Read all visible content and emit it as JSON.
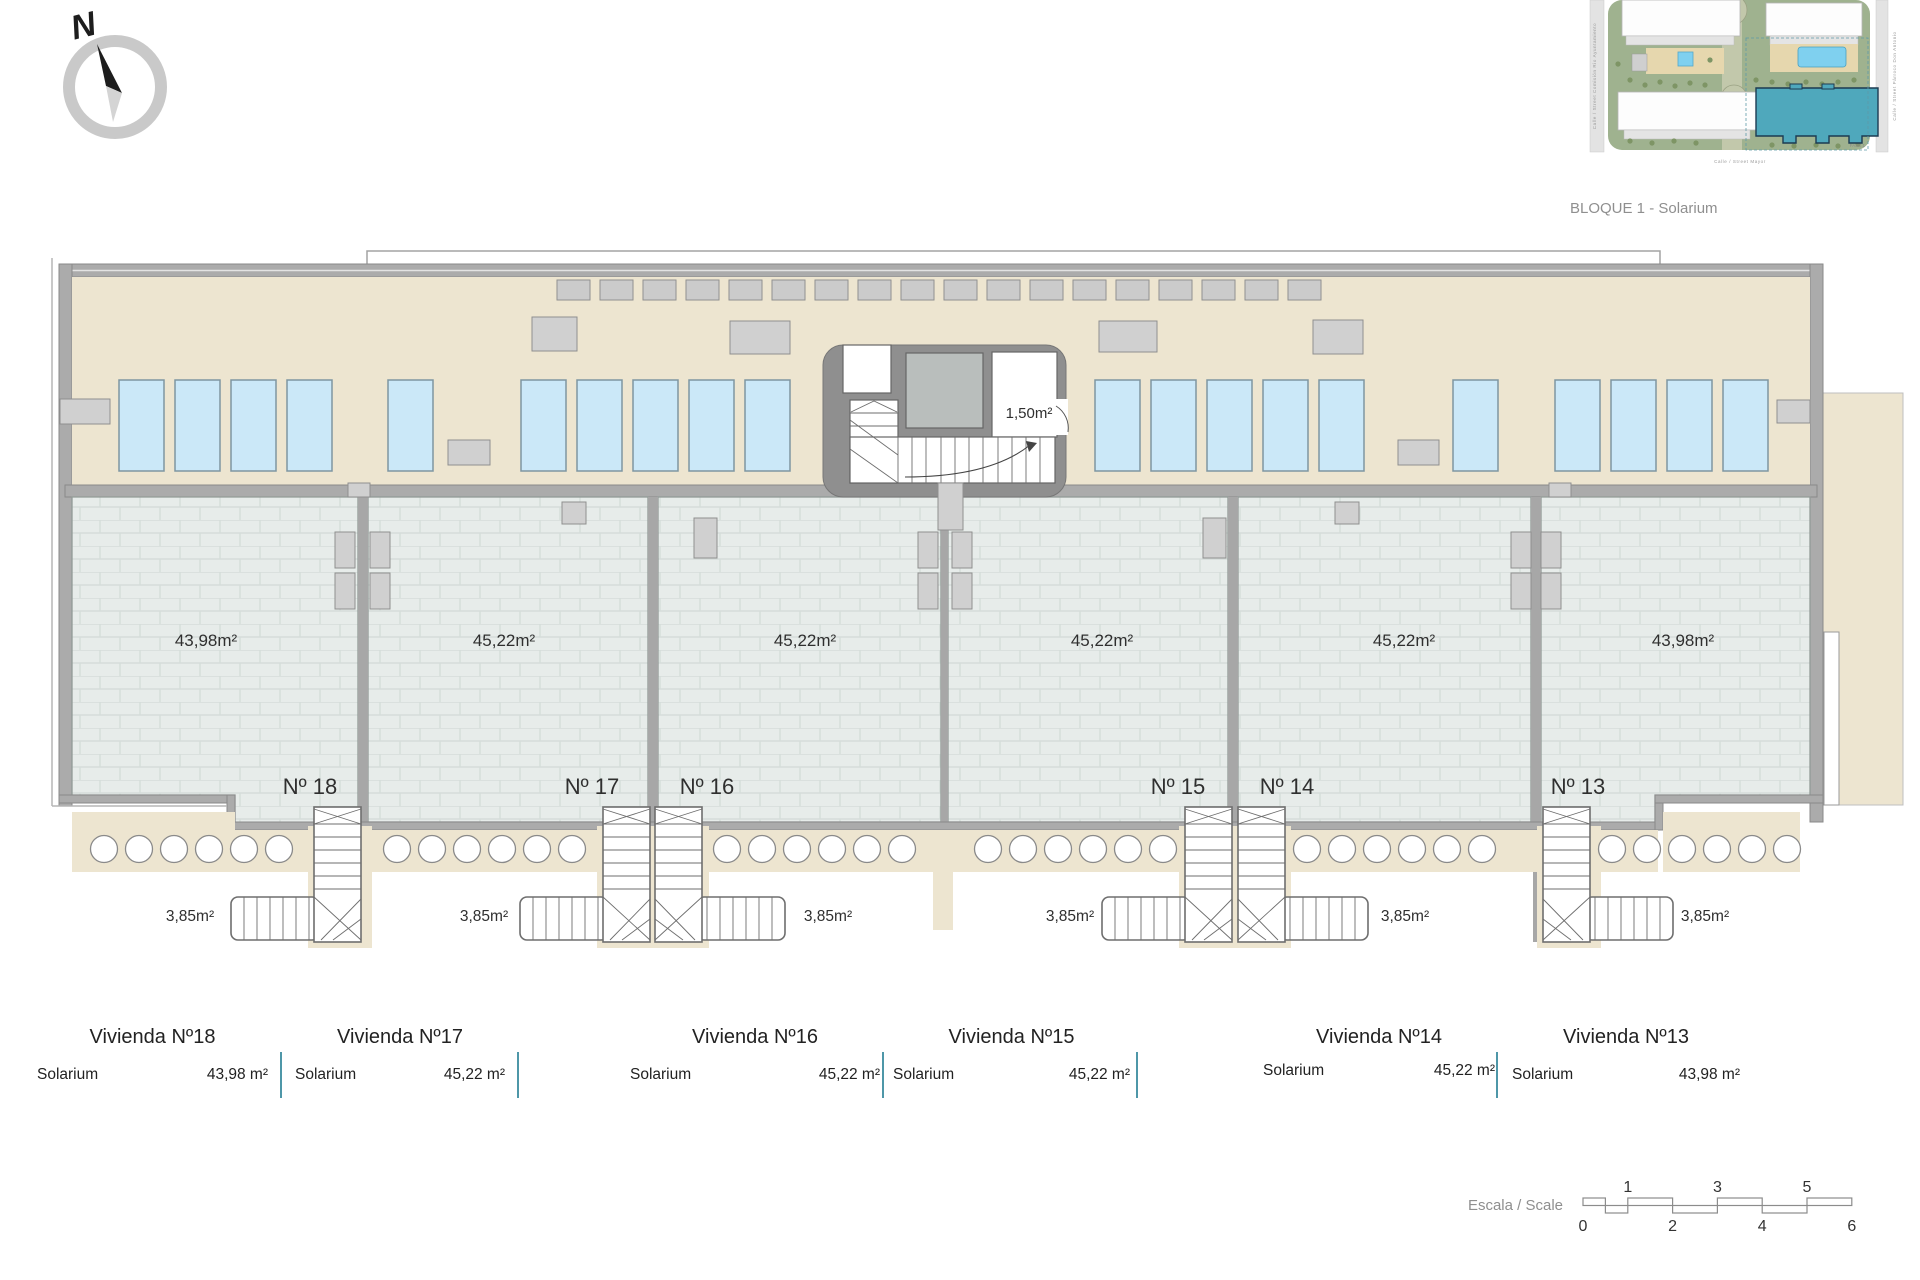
{
  "colors": {
    "beige": "#EDE5D0",
    "tile": "#E7ECEA",
    "tile_line": "#D5DDDA",
    "wall": "#A9A9A9",
    "core_wall": "#8F8F8F",
    "sunbed": "#CBE8F8",
    "sunbed_border": "#7E96A1",
    "fixture_gray": "#D0D0D0",
    "table_divider": "#4E97A8",
    "site_green": "#9FB28F",
    "site_teal": "#4FA8BC",
    "pool_blue": "#7FD0EF",
    "deck_beige": "#E6D7AE",
    "text_dark": "#3B3B3B",
    "text_gray": "#8F8F8F"
  },
  "compass": {
    "label": "N"
  },
  "site_plan": {
    "caption": "BLOQUE 1 - Solarium",
    "street_left": "Calle / Street Comisión Rio Ayuntamiento",
    "street_right": "Calle / Street Párroco Don Antonio",
    "street_bottom": "Calle / Street Mayor",
    "phase_label": "FASE 1"
  },
  "plan": {
    "core_area": "1,50m²"
  },
  "units": [
    {
      "number": "Nº 18",
      "solarium_area": "43,98m²",
      "stair_area": "3,85m²",
      "vivienda_title": "Vivienda Nº18",
      "room_label": "Solarium",
      "room_area": "43,98 m²"
    },
    {
      "number": "Nº 17",
      "solarium_area": "45,22m²",
      "stair_area": "3,85m²",
      "vivienda_title": "Vivienda Nº17",
      "room_label": "Solarium",
      "room_area": "45,22 m²"
    },
    {
      "number": "Nº 16",
      "solarium_area": "45,22m²",
      "stair_area": "3,85m²",
      "vivienda_title": "Vivienda Nº16",
      "room_label": "Solarium",
      "room_area": "45,22 m²"
    },
    {
      "number": "Nº 15",
      "solarium_area": "45,22m²",
      "stair_area": "3,85m²",
      "vivienda_title": "Vivienda Nº15",
      "room_label": "Solarium",
      "room_area": "45,22 m²"
    },
    {
      "number": "Nº 14",
      "solarium_area": "45,22m²",
      "stair_area": "3,85m²",
      "vivienda_title": "Vivienda Nº14",
      "room_label": "Solarium",
      "room_area": "45,22 m²"
    },
    {
      "number": "Nº 13",
      "solarium_area": "43,98m²",
      "stair_area": "3,85m²",
      "vivienda_title": "Vivienda Nº13",
      "room_label": "Solarium",
      "room_area": "43,98 m²"
    }
  ],
  "scale_bar": {
    "label": "Escala / Scale",
    "top_ticks": [
      "1",
      "3",
      "5"
    ],
    "bottom_ticks": [
      "0",
      "2",
      "4",
      "6"
    ]
  }
}
